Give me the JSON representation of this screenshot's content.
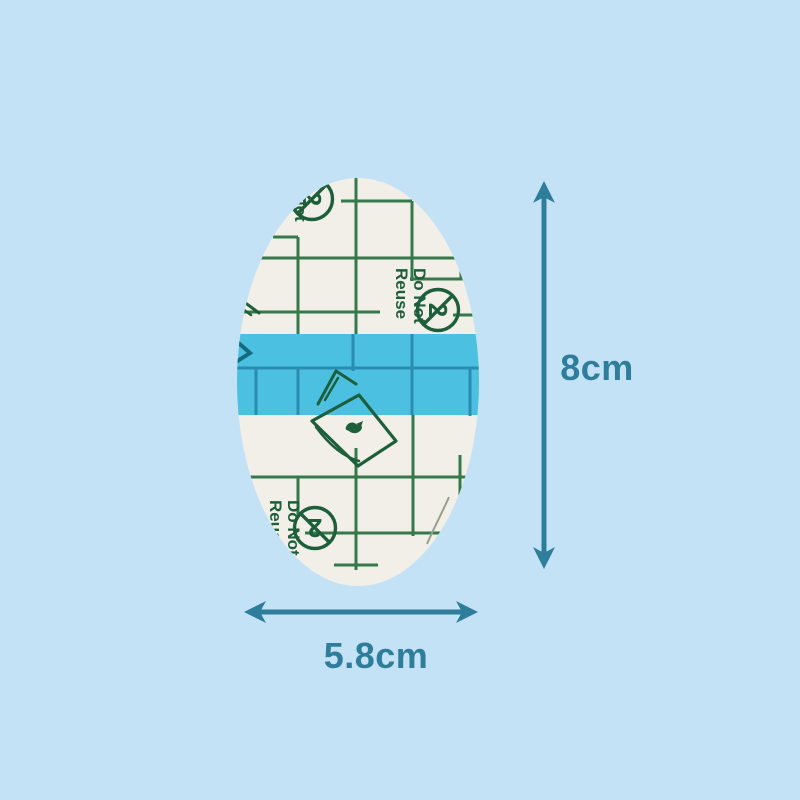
{
  "background_color": "#c4e2f5",
  "product": {
    "backing_color": "#f2efe8",
    "grid_color": "#35784a",
    "print_color": "#1e5f3b",
    "band_color": "#4cc0e0",
    "band_grid_color": "#2a8cb0",
    "liner_print": {
      "line1": "Do Not",
      "line2": "Reuse",
      "no_reuse_glyph": "2"
    },
    "icons": {
      "no_reuse_symbol": "circled-2-crossed-icon",
      "peel_icon": "peel-corner-hand-icon"
    }
  },
  "dimensions": {
    "arrow_color": "#2e7d9b",
    "height_label": "8cm",
    "width_label": "5.8cm"
  }
}
